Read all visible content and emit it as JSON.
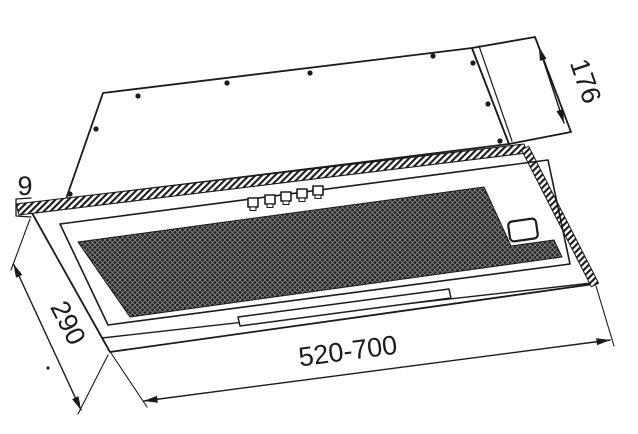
{
  "diagram": {
    "dimensions": {
      "top_section_depth": "176",
      "front_frame_thickness": "9",
      "body_depth": "290",
      "body_width_range": "520-700"
    },
    "colors": {
      "line": "#1b1b1b",
      "background": "#ffffff",
      "mesh_fill": "#242424",
      "mesh_grid": "#8a8a8a"
    }
  }
}
